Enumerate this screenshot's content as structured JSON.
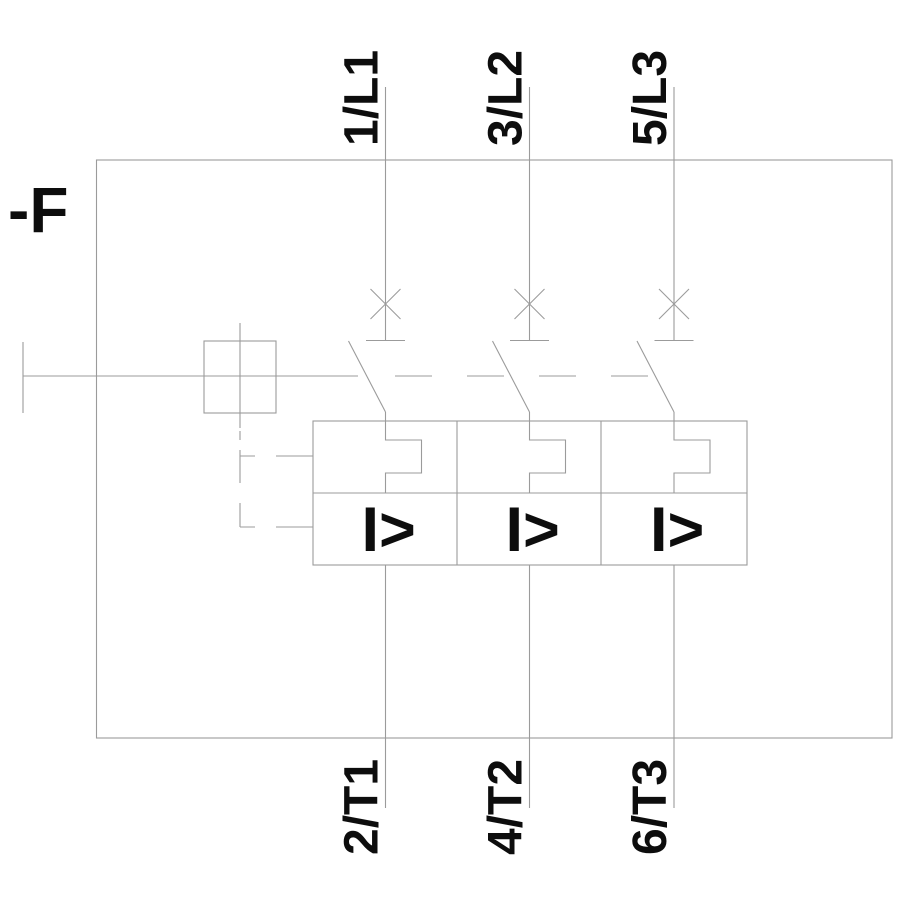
{
  "diagram": {
    "type": "circuit-breaker-schematic",
    "device_label": "-F",
    "magnetic_trip_symbol": "I>",
    "poles": [
      {
        "top_terminal": "1/L1",
        "bottom_terminal": "2/T1"
      },
      {
        "top_terminal": "3/L2",
        "bottom_terminal": "4/T2"
      },
      {
        "top_terminal": "5/L3",
        "bottom_terminal": "6/T3"
      }
    ],
    "colors": {
      "line": "#9b9b9b",
      "text": "#0d0d0d",
      "background": "#ffffff"
    }
  }
}
